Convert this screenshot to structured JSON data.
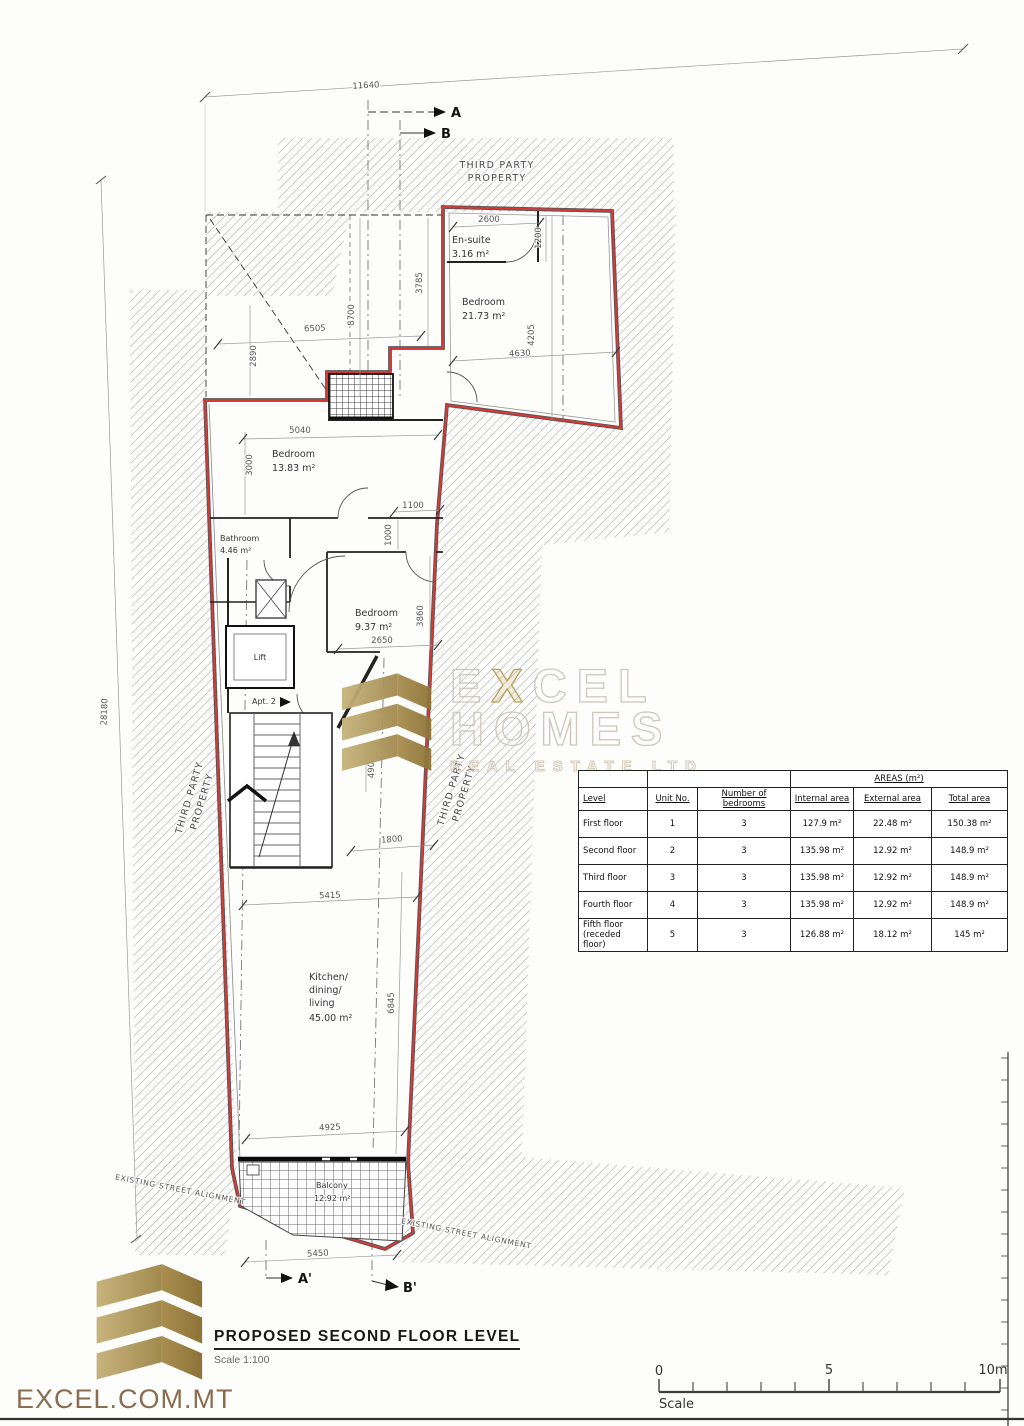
{
  "plan": {
    "dims": {
      "d11640": "11640",
      "d28180": "28180",
      "d2600": "2600",
      "d1200": "1200",
      "d3785": "3785",
      "d8700": "8700",
      "d6505": "6505",
      "d2890": "2890",
      "d4630": "4630",
      "d4205": "4205",
      "d5040": "5040",
      "d3000": "3000",
      "d1100": "1100",
      "d1000": "1000",
      "d2650": "2650",
      "d3860": "3860",
      "d490": "490",
      "d1800": "1800",
      "d5415": "5415",
      "d6845": "6845",
      "d4925": "4925",
      "d5450": "5450"
    },
    "rooms": {
      "ensuite": {
        "name": "En-suite",
        "area": "3.16 m²"
      },
      "bed1": {
        "name": "Bedroom",
        "area": "21.73 m²"
      },
      "bed2": {
        "name": "Bedroom",
        "area": "13.83 m²"
      },
      "bath": {
        "name": "Bathroom",
        "area": "4.46 m²"
      },
      "bed3": {
        "name": "Bedroom",
        "area": "9.37 m²"
      },
      "kitchen": {
        "l1": "Kitchen/",
        "l2": "dining/",
        "l3": "living",
        "area": "45.00 m²"
      },
      "balcony": {
        "name": "Balcony",
        "area": "12.92 m²"
      },
      "lift": "Lift",
      "apt": "Apt. 2"
    },
    "labels": {
      "third_party_l1": "THIRD PARTY",
      "third_party_l2": "PROPERTY",
      "street": "EXISTING STREET ALIGNMENT"
    },
    "sections": {
      "a": "A",
      "b": "B",
      "a2": "A'",
      "b2": "B'"
    }
  },
  "areas_table": {
    "title": "AREAS (m²)",
    "headers": {
      "level": "Level",
      "unit": "Unit No.",
      "bedrooms": "Number of bedrooms",
      "internal": "Internal area",
      "external": "External area",
      "total": "Total area"
    },
    "rows": [
      {
        "level": "First floor",
        "unit": "1",
        "bedrooms": "3",
        "internal": "127.9 m²",
        "external": "22.48 m²",
        "total": "150.38 m²"
      },
      {
        "level": "Second floor",
        "unit": "2",
        "bedrooms": "3",
        "internal": "135.98 m²",
        "external": "12.92 m²",
        "total": "148.9 m²"
      },
      {
        "level": "Third floor",
        "unit": "3",
        "bedrooms": "3",
        "internal": "135.98 m²",
        "external": "12.92 m²",
        "total": "148.9 m²"
      },
      {
        "level": "Fourth floor",
        "unit": "4",
        "bedrooms": "3",
        "internal": "135.98 m²",
        "external": "12.92 m²",
        "total": "148.9 m²"
      },
      {
        "level": "Fifth floor (receded floor)",
        "unit": "5",
        "bedrooms": "3",
        "internal": "126.88 m²",
        "external": "18.12 m²",
        "total": "145 m²"
      }
    ]
  },
  "watermark": {
    "word1_pre": "E",
    "word1_x": "X",
    "word1_post": "CEL",
    "word2": "HOMES",
    "word3": "REAL ESTATE LTD"
  },
  "footer": {
    "brand": "EXCEL.COM.MT",
    "title": "PROPOSED SECOND FLOOR LEVEL",
    "scale_note": "Scale 1:100"
  },
  "scalebar": {
    "t0": "0",
    "t5": "5",
    "t10": "10m",
    "label": "Scale"
  },
  "colors": {
    "unit_outline": "#d63838",
    "brand_gold": "#b3a068",
    "brand_gold_dark": "#9c8140",
    "brand_text": "#8a6c50"
  }
}
